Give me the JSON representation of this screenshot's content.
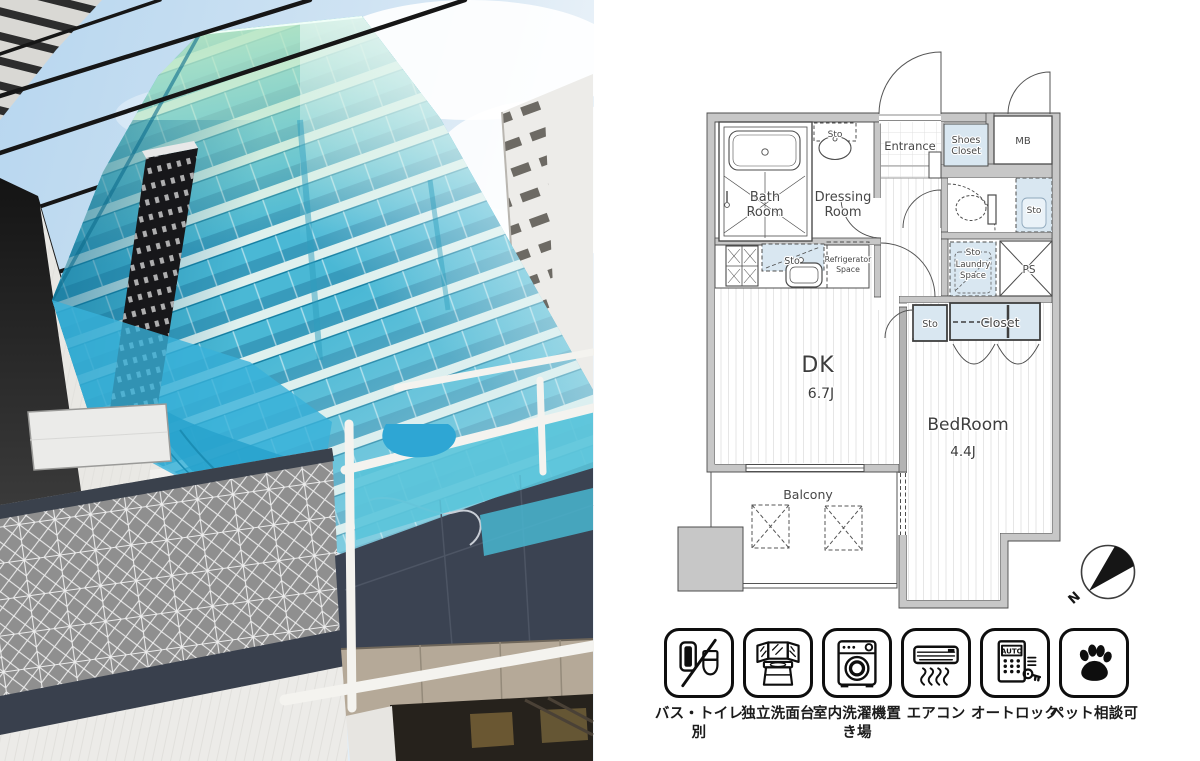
{
  "photo": {
    "description": "Low-angle exterior photo of a glass-clad building with power lines",
    "colors": {
      "sky": "#bedaf0",
      "sky_pale": "#eef4f9",
      "glass_mid": "#45b6d3",
      "glass_green": "#b9e7c4",
      "mesh": "#38b2da",
      "panel_navy": "#3b4352",
      "pattern_gray": "#8f8f8f",
      "wall_white": "#eceae6",
      "left_dark": "#1a1a1a",
      "beige": "#b5a998",
      "power_line": "#161616"
    }
  },
  "plan": {
    "colors": {
      "wall": "#c7c7c7",
      "line": "#4c4c4c",
      "shade": "#d9e7f1",
      "floor_stripe": "#e6e6e6"
    },
    "labels": {
      "bath": [
        "Bath",
        "Room"
      ],
      "dressing": [
        "Dressing",
        "Room"
      ],
      "entrance": "Entrance",
      "shoes_closet": [
        "Shoes",
        "Closet"
      ],
      "mb": "MB",
      "sto": "Sto",
      "refrigerator": [
        "Refrigerator",
        "Space"
      ],
      "laundry": [
        "Sto",
        "Laundry",
        "Space"
      ],
      "ps": "PS",
      "closet": "Closet",
      "dk": "DK",
      "dk_size": "6.7J",
      "bedroom": "BedRoom",
      "bedroom_size": "4.4J",
      "balcony": "Balcony",
      "north": "N"
    }
  },
  "amenities": [
    {
      "icon": "bath-toilet-separate-icon",
      "label_lines": [
        "バス・トイレ",
        "別"
      ]
    },
    {
      "icon": "independent-washbasin-icon",
      "label_lines": [
        "独立洗面台"
      ]
    },
    {
      "icon": "indoor-washer-icon",
      "label_lines": [
        "室内洗濯機置",
        "き場"
      ]
    },
    {
      "icon": "air-conditioner-icon",
      "label_lines": [
        "エアコン"
      ]
    },
    {
      "icon": "auto-lock-icon",
      "label_lines": [
        "オートロック"
      ],
      "badge": "AUTO"
    },
    {
      "icon": "pet-consult-icon",
      "label_lines": [
        "ペット相談可"
      ]
    }
  ]
}
